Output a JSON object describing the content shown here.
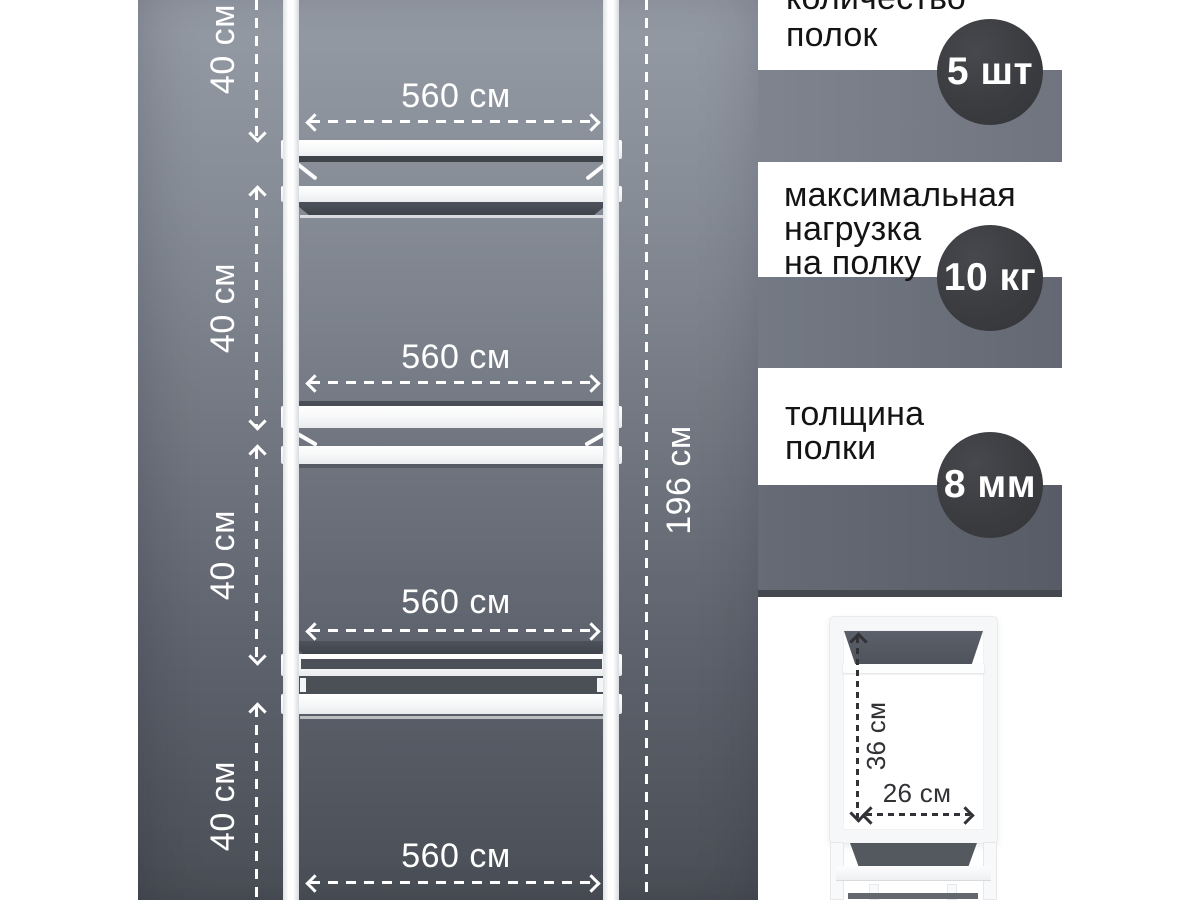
{
  "panel": {
    "total_height": "196 см",
    "tiers": [
      {
        "height": "40 см",
        "width": "560 см"
      },
      {
        "height": "40 см",
        "width": "560 см"
      },
      {
        "height": "40 см",
        "width": "560 см"
      },
      {
        "height": "40 см",
        "width": "560 см"
      }
    ]
  },
  "specs": [
    {
      "label": "количество\nполок",
      "value": "5 шт"
    },
    {
      "label": "максимальная\nнагрузка\nна полку",
      "value": "10 кг"
    },
    {
      "label": "толщина\nполки",
      "value": "8 мм"
    }
  ],
  "side_view": {
    "depth": "36 см",
    "width": "26 см"
  },
  "colors": {
    "badge": "#3b3c40",
    "backdrop_top": "#959ba5",
    "backdrop_bottom": "#4a4e56",
    "spec_band": "#6d727c",
    "dimension_line": "#ffffff",
    "spec_text": "#141414"
  }
}
